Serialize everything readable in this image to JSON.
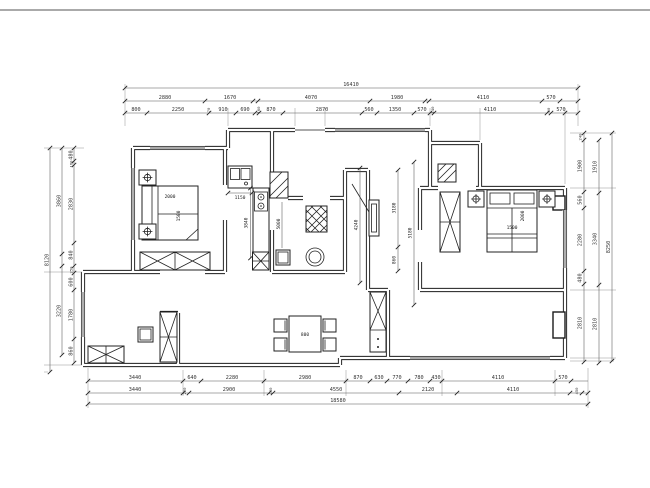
{
  "dims": {
    "top": {
      "total": "16410",
      "row2": [
        "2880",
        "1670",
        "4070",
        "1980",
        "4110",
        "570"
      ],
      "row3": [
        "800",
        "2250",
        "70",
        "910",
        "690",
        "160",
        "870",
        "2870",
        "560",
        "1350",
        "570",
        "140",
        "4110",
        "60",
        "570"
      ]
    },
    "bottom": {
      "row1": [
        "3440",
        "640",
        "2280",
        "2980",
        "870",
        "630",
        "770",
        "780",
        "430",
        "4110",
        "570"
      ],
      "row2": [
        "3440",
        "220",
        "2900",
        "130",
        "4550",
        "2120",
        "4110",
        "450"
      ],
      "total": "18580"
    },
    "left": {
      "inner": [
        "480",
        "160",
        "2830",
        "840",
        "250",
        "600",
        "1780",
        "860"
      ],
      "mid": [
        "3860",
        "3220"
      ],
      "total": "8120"
    },
    "right": {
      "inner": [
        "240",
        "1900",
        "560",
        "2280",
        "480",
        "2810"
      ],
      "mid": [
        "1910",
        "3340",
        "2810"
      ],
      "total": "8250"
    },
    "interior": {
      "sink_width": "1150",
      "kitchen_counter": "3840",
      "hall_depth": "5000",
      "bed2_width": "2000",
      "bed2_depth": "1500",
      "tv_wall": "4240",
      "living_width": "3180",
      "living_gap": "860",
      "master_span": "5180",
      "bed1_width": "1500",
      "bed1_depth": "2000",
      "dining_table": "800"
    }
  }
}
